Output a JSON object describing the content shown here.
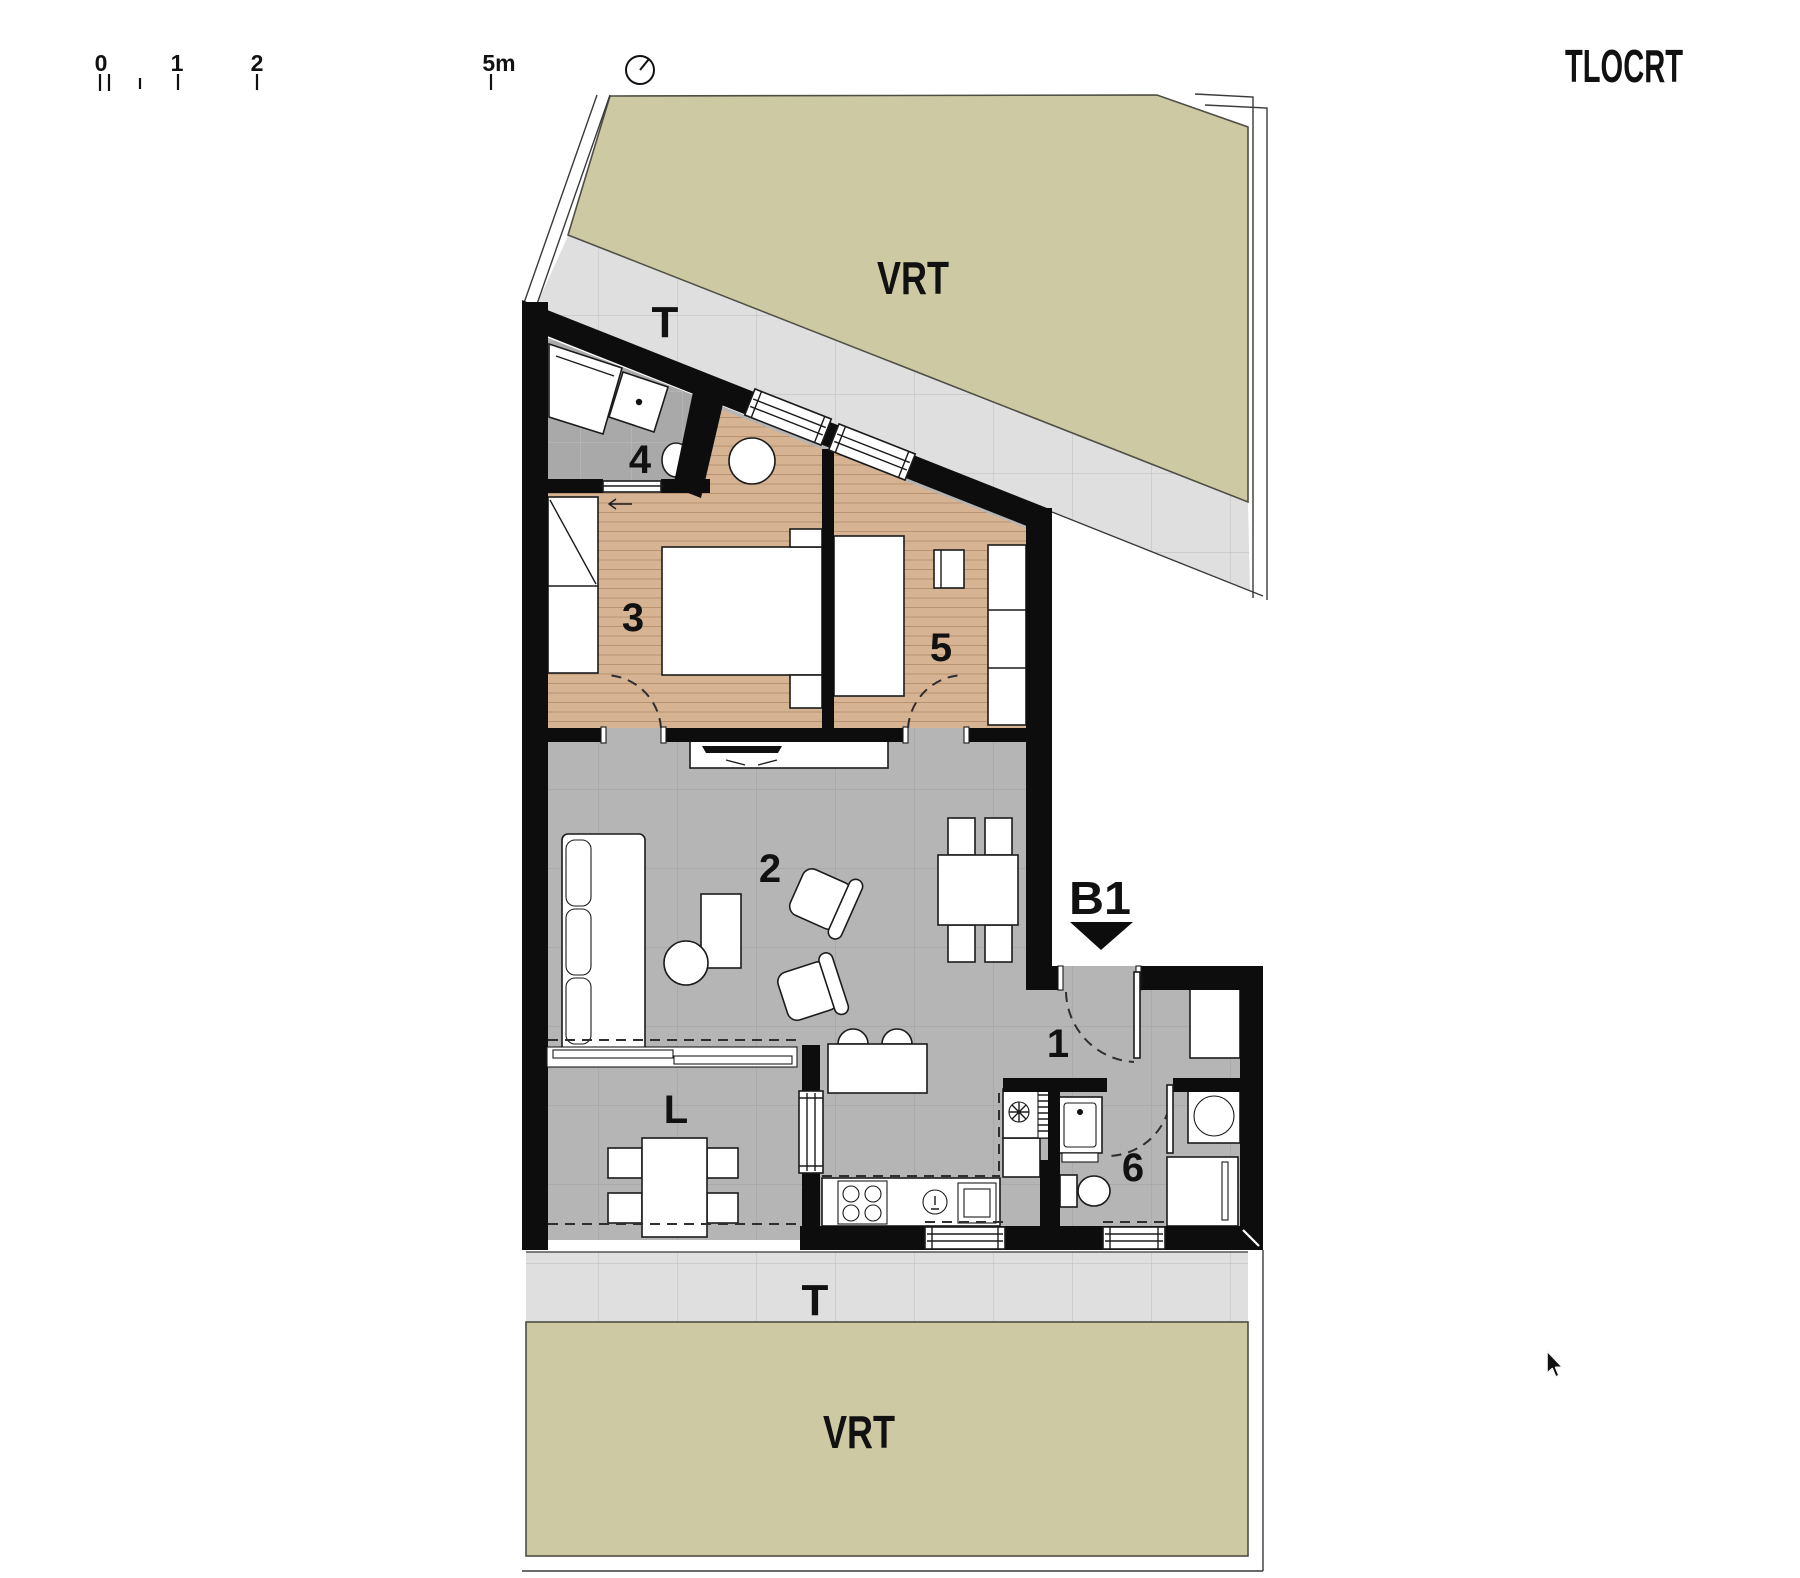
{
  "header": {
    "title": "TLOCRT"
  },
  "scale_bar": {
    "labels": [
      "0",
      "1",
      "2",
      "5m"
    ]
  },
  "plan": {
    "garden_top": "VRT",
    "garden_bottom": "VRT",
    "terrace_top": "T",
    "terrace_bottom": "T",
    "section_mark": "B1",
    "room_labels": {
      "entry": "1",
      "living": "2",
      "bedroom1": "3",
      "bathroom1": "4",
      "bedroom2": "5",
      "bathroom2": "6",
      "loggia": "L"
    }
  },
  "colors": {
    "garden": "#ccc9a3",
    "garden-edge": "#4f4e44",
    "terrace": "#dfdfdf",
    "terrace-line": "#c2c2c2",
    "floor": "#b5b5b5",
    "floor-line": "#a4a4a4",
    "bath-floor": "#a9a9a9",
    "bath-line": "#bdbdbd",
    "wood": "#d6b493",
    "wood-line": "#b9926f",
    "wall": "#0d0d0d",
    "fixture-stroke": "#1b1b1b",
    "dash": "#2e2e2e"
  }
}
